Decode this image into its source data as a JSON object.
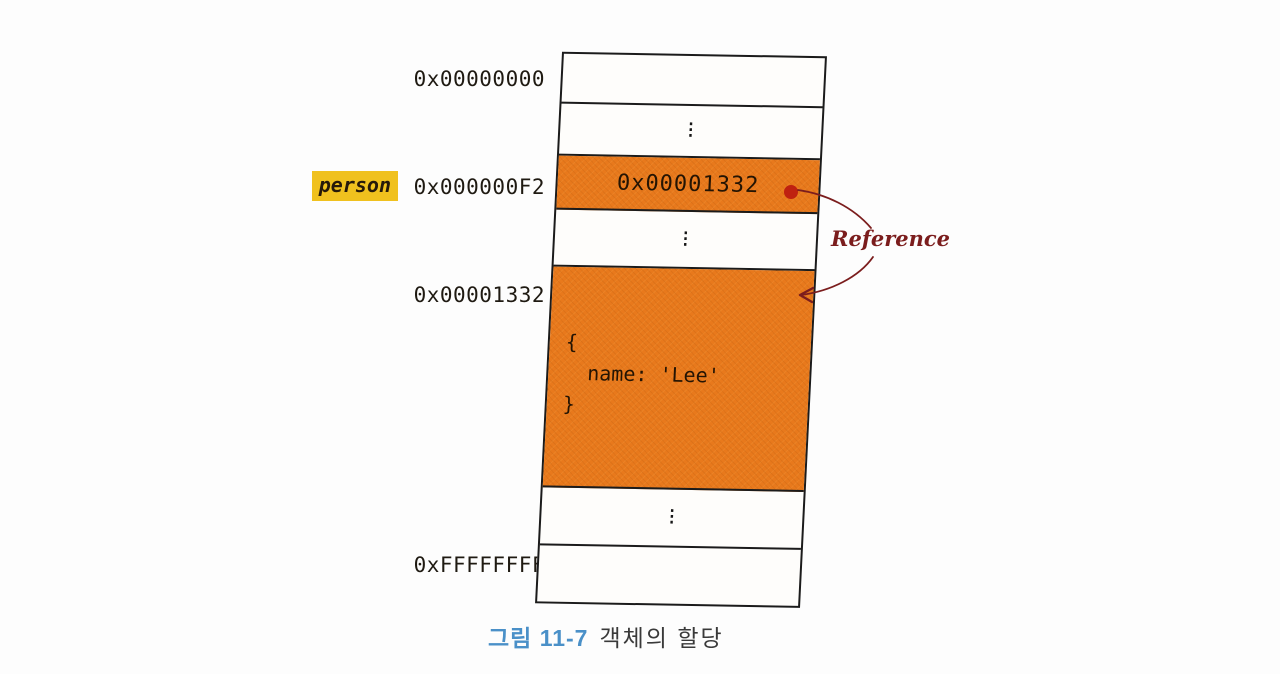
{
  "address_labels": {
    "top": "0x00000000",
    "variable": "person",
    "pointer": "0x000000F2",
    "object": "0x00001332",
    "bottom": "0xFFFFFFFF"
  },
  "cells": {
    "ellipsis": "⋮",
    "pointer_value": "0x00001332",
    "object_open": "{",
    "object_body": "name: 'Lee'",
    "object_close": "}"
  },
  "annotation": {
    "reference_label": "Reference"
  },
  "caption": {
    "number": "그림 11-7",
    "title": "객체의 할당"
  },
  "colors": {
    "cell_fill_orange": "#e8791c",
    "highlight_yellow": "#f0c11e",
    "annotation_maroon": "#7b1d1d",
    "reference_dot_red": "#bf2110",
    "caption_blue": "#4a90c8",
    "border_black": "#1b1b1b"
  }
}
